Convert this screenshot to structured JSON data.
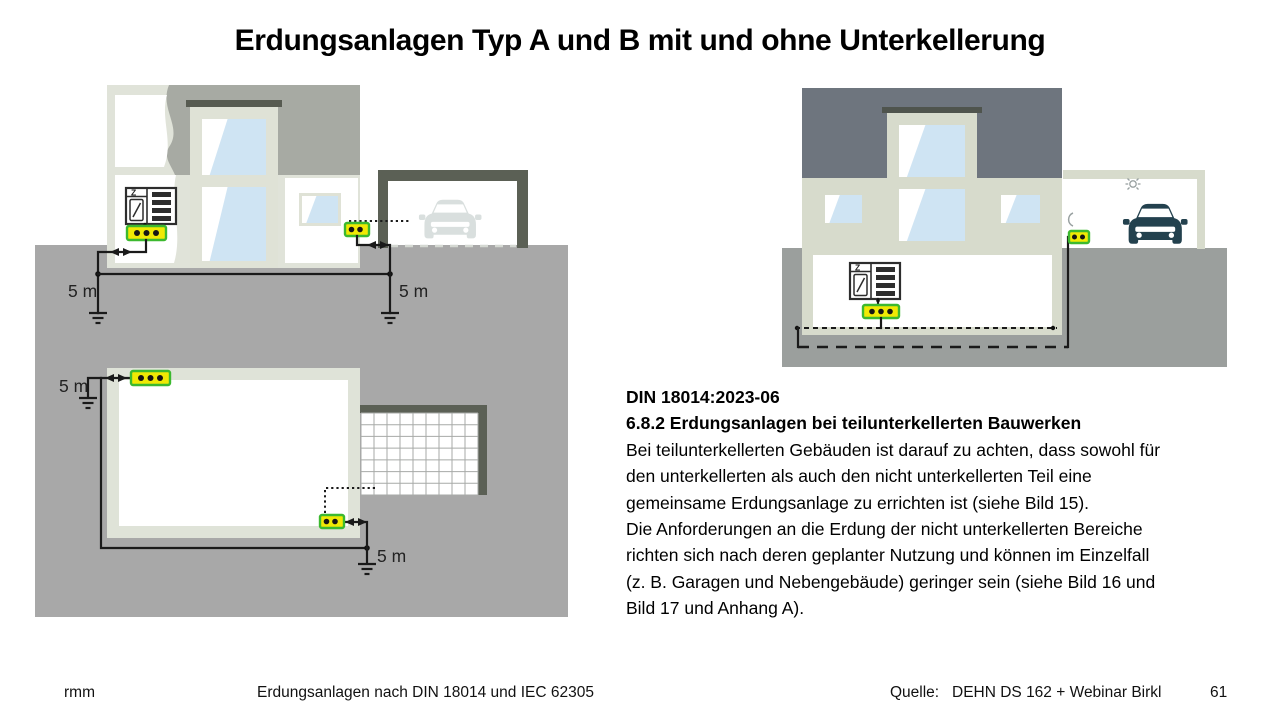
{
  "slide": {
    "title": "Erdungsanlagen Typ A und B mit und ohne Unterkellerung",
    "body": {
      "heading1": "DIN 18014:2023-06",
      "heading2": "6.8.2 Erdungsanlagen bei teilunterkellerten Bauwerken",
      "lines": [
        "Bei teilunterkellerten Gebäuden ist darauf zu achten, dass sowohl für",
        "den unterkellerten als auch den nicht unterkellerten Teil eine",
        "gemeinsame Erdungsanlage zu errichten ist (siehe Bild 15).",
        "Die Anforderungen an die Erdung der nicht unterkellerten Bereiche",
        "richten sich nach deren geplanter Nutzung und können im Einzelfall",
        "(z. B. Garagen und Nebengebäude) geringer sein (siehe Bild 16 und",
        "Bild 17 und Anhang A)."
      ]
    },
    "diagrams": {
      "cross_section": {
        "left_rod_label": "5 m",
        "right_rod_label": "5 m",
        "meter_label": "Z"
      },
      "plan_view": {
        "left_rod_label": "5 m",
        "right_rod_label": "5 m"
      },
      "partial_basement": {
        "meter_label": "Z"
      }
    },
    "footer": {
      "author": "rmm",
      "center": "Erdungsanlagen nach DIN 18014 und IEC 62305",
      "source_label": "Quelle:",
      "source_value": "DEHN DS 162 + Webinar Birkl",
      "page": "61"
    },
    "colors": {
      "ground_gray": "#a8a8a8",
      "ground_gray_right": "#9b9f9d",
      "house_light_green": "#dfe3d8",
      "cutaway_gray": "#a7aaa3",
      "roof_slate": "#6e757e",
      "garage_dark_frame": "#5b6055",
      "window_blue": "#cfe4f3",
      "terminal_green": "#3cb92f",
      "terminal_yellow": "#f0e904",
      "car_teal": "#23414e",
      "car_faint": "#d9dfde",
      "conductor_black": "#1a1a1a"
    },
    "icons": {
      "car_front": "car-front-silhouette",
      "ceiling_lamp": "lamp-with-rays-icon",
      "wall_socket": "wall-bracket-icon",
      "earth_rod": "earth-ground-symbol",
      "terminal_bar": "equipotential-bonding-bar",
      "meter_cabinet": "meter-cabinet-icon"
    }
  }
}
